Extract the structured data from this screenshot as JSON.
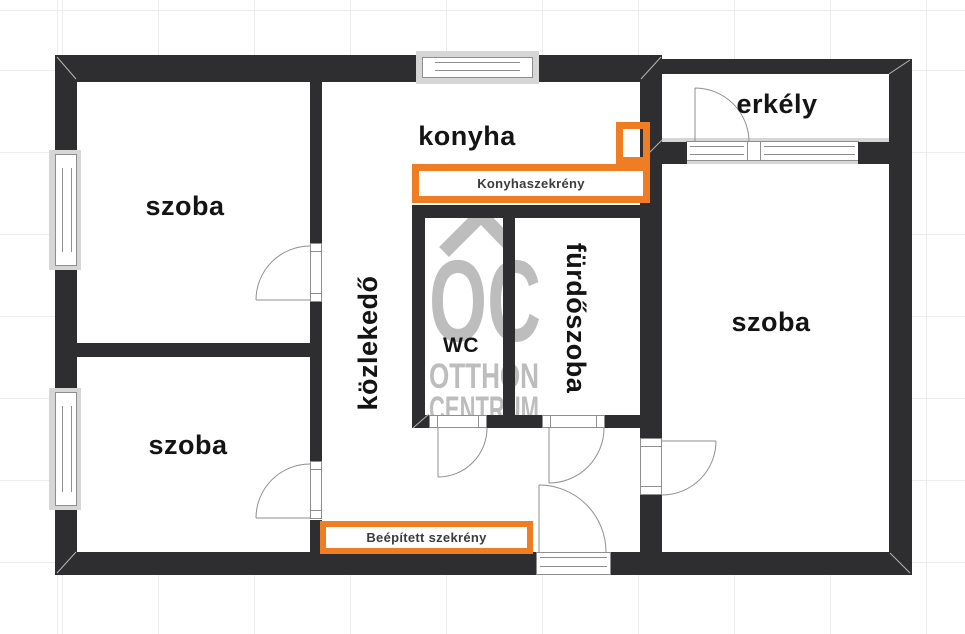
{
  "floorplan": {
    "rooms": [
      {
        "id": "szoba-top-left",
        "label": "szoba"
      },
      {
        "id": "szoba-bottom-left",
        "label": "szoba"
      },
      {
        "id": "konyha",
        "label": "konyha"
      },
      {
        "id": "erkely",
        "label": "erkély"
      },
      {
        "id": "szoba-right",
        "label": "szoba"
      },
      {
        "id": "kozlekedo",
        "label": "közlekedő"
      },
      {
        "id": "wc",
        "label": "WC"
      },
      {
        "id": "furdoszoba",
        "label": "fürdőszoba"
      }
    ],
    "fixtures": [
      {
        "id": "kitchen-cabinet",
        "label": "Konyhaszekrény"
      },
      {
        "id": "built-in-wardrobe",
        "label": "Beépített szekrény"
      }
    ],
    "watermark": {
      "monogram": "OC",
      "line1": "OTTHON",
      "line2": "CENTRUM"
    },
    "colors": {
      "wall": "#2e2e30",
      "accent_orange": "#EF7D23",
      "watermark_gray": "#bdbdbd",
      "window_frame": "#8e8e8e",
      "window_surround": "#d6d6d6"
    }
  }
}
